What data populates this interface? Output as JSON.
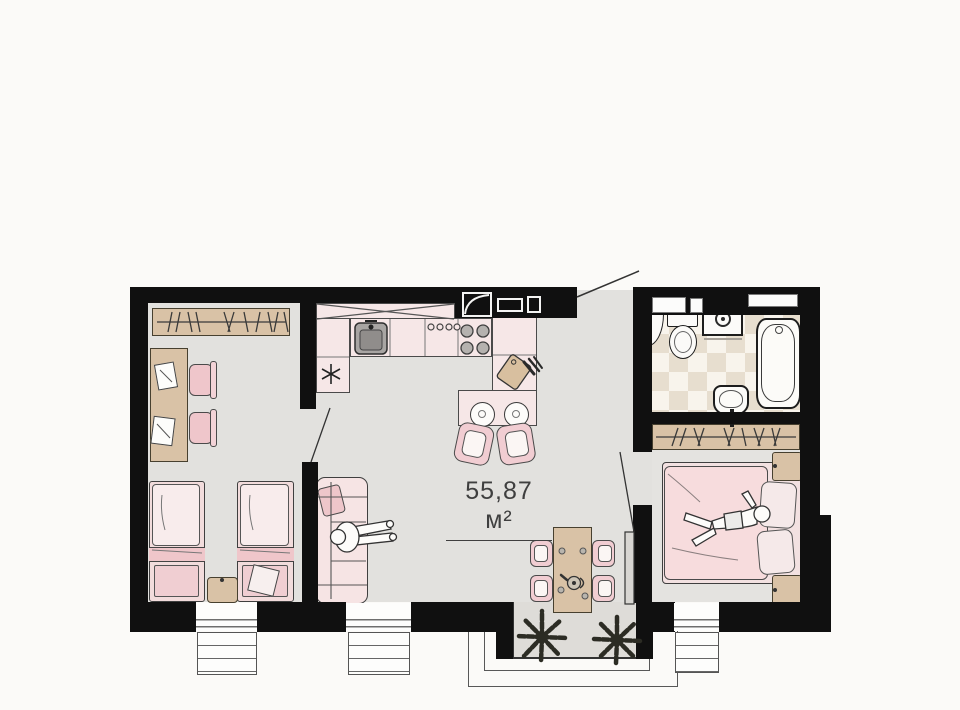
{
  "floor_plan": {
    "area_label": "55,87 м²",
    "colors": {
      "wall": "#101010",
      "floor": "#e2e1de",
      "outside": "#fbfaf8",
      "furniture_pink": "#f6e7e7",
      "accent_pink": "#efc6ca",
      "wood_tan": "#d9c2a6",
      "tile_dark": "#e7decf",
      "tile_light": "#f8f4ec",
      "label_text": "#3f3f3f"
    },
    "rooms": {
      "children_room": {
        "icons": [
          "wardrobe-icon",
          "desk-icon",
          "paper-icon",
          "desk-chair-icon",
          "single-bed-icon",
          "single-bed-icon",
          "nightstand-icon"
        ]
      },
      "kitchen_living": {
        "icons": [
          "upper-cabinet-x-icon",
          "kitchen-counter-icon",
          "kitchen-sink-icon",
          "stove-burners-icon",
          "fridge-asterisk-icon",
          "cutting-board-icon",
          "knives-icon",
          "bar-counter-icon",
          "bar-stool-icon",
          "bar-chair-icon",
          "sofa-icon",
          "sofa-pillow-icon",
          "person-sitting-icon",
          "dining-table-icon",
          "dining-chair-icon",
          "teapot-icon"
        ]
      },
      "hallway": {
        "icons": [
          "entrance-door-swing-icon",
          "vent-shaft-icon"
        ]
      },
      "bathroom": {
        "icons": [
          "toilet-icon",
          "washing-machine-icon",
          "bathtub-icon",
          "washbasin-icon",
          "vent-box-icon",
          "corner-shelf-icon"
        ]
      },
      "bedroom": {
        "icons": [
          "wardrobe-icon",
          "double-bed-icon",
          "pillow-icon",
          "nightstand-icon",
          "person-lying-icon",
          "door-leaf-icon"
        ]
      },
      "terrace": {
        "icons": [
          "plant-icon",
          "plant-icon",
          "terrace-outline"
        ]
      }
    },
    "window_count": 3
  }
}
